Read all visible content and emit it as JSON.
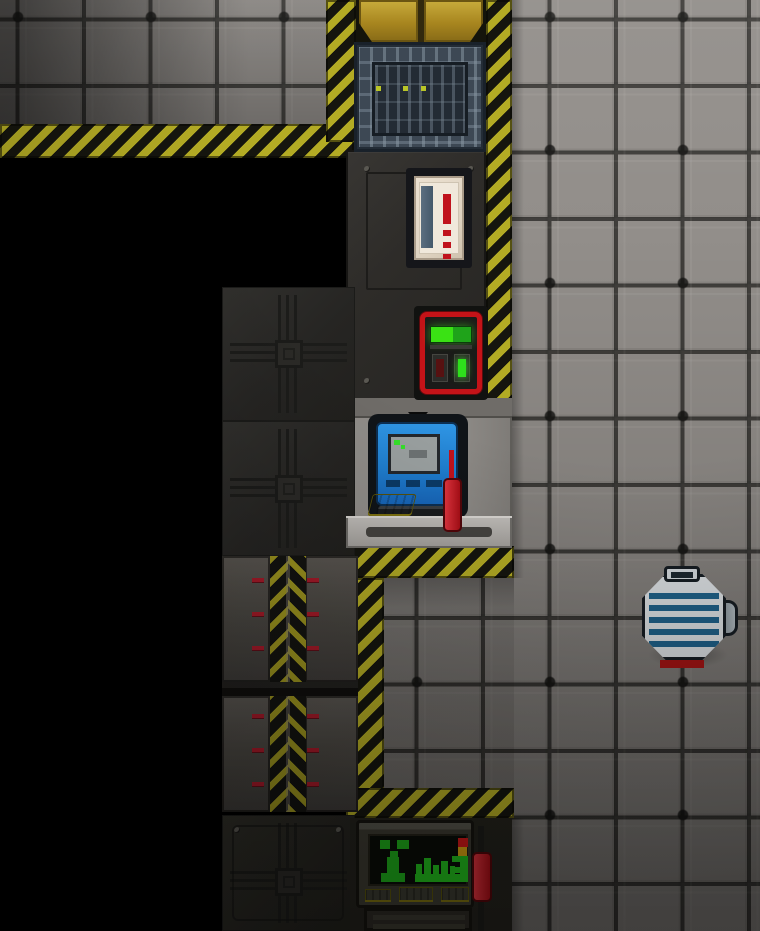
{
  "scene": {
    "description": "Top-down sci-fi space-station tile map: gray steel floor, yellow-black hazard walls, black unlit void, wall machines and a striped maintenance robot",
    "visible_text": "none"
  },
  "theme": {
    "hazard-yellow": "#b3ab24",
    "hazard-dark": "#15150e",
    "floor-base": "#928e8a",
    "floor-line": "#403e3b",
    "wall-dark": "#302e2b",
    "plating-dark": "#262523",
    "alcove-gray": "#8d8a86",
    "gold-door": "#b0902a",
    "apc-red": "#c41318",
    "display-green": "#2fd41f",
    "computer-blue": "#1f7fd0",
    "keyboard-yellow": "#d8c922",
    "extinguisher-red": "#c0121c",
    "bot-stripe-blue": "#1f5f86",
    "blast-panel": "#4b4845",
    "dash-red": "#a31a28",
    "window-frame": "#3d4854",
    "window-glass": "#232b34",
    "void-black": "#000000"
  },
  "objects": {
    "floor": {
      "label": "gray steel tile floor"
    },
    "left_room_floor": {
      "label": "dim floor of adjacent room (top-left)"
    },
    "void": {
      "label": "black unlit void"
    },
    "hazard_wall": {
      "label": "yellow-black hazard striped wall"
    },
    "gold_door": {
      "label": "gold security door (top edge, partly visible)"
    },
    "window": {
      "label": "reinforced grille window with three small lights"
    },
    "extinguisher_cabinet": {
      "label": "white wall cabinet holding red extinguisher"
    },
    "apc": {
      "label": "red APC power unit with green charge display and two buttons"
    },
    "computer": {
      "label": "blue computer console with screen, yellow keyboard"
    },
    "computer_extinguisher": {
      "label": "red fire extinguisher beside computer"
    },
    "table": {
      "label": "light gray console table front rail"
    },
    "plating": {
      "label": "dark circuit-pattern plating tiles"
    },
    "blast_doors": {
      "label": "closed blast doors with upward chevron stripe and red markers"
    },
    "monitor_console": {
      "label": "monitoring console: green plant glyph, bar graph, red-yellow-green gauge, yellow keys"
    },
    "console_extinguisher": {
      "label": "red fire extinguisher mounted beside monitor console"
    },
    "floorbot": {
      "label": "round maintenance robot, white with blue stripes, side nozzle, red feet"
    }
  }
}
